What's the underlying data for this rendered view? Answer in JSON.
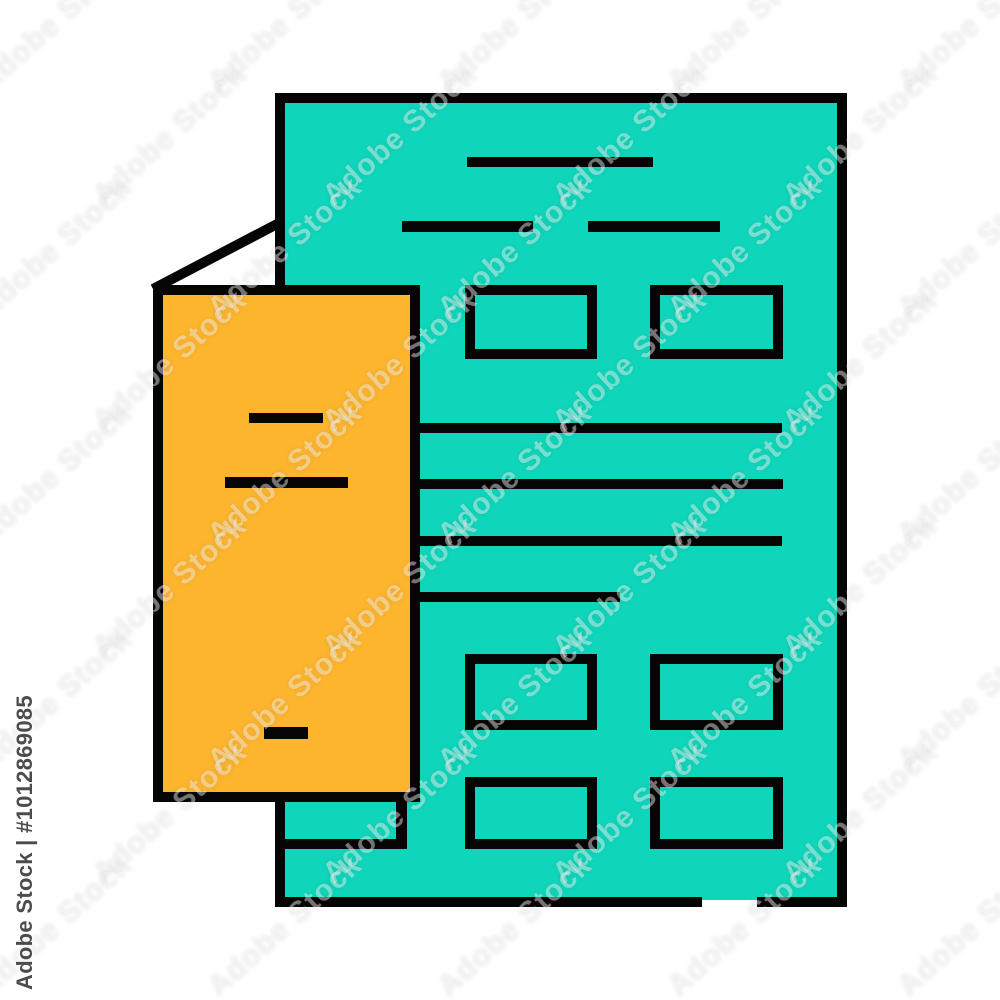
{
  "image": {
    "kind": "stock icon preview",
    "subject": "document page with bookmark card - flat color line icon (teal sheet with text lines and outlined field boxes, orange bookmark with folded corner)"
  },
  "colors": {
    "background": "#ffffff",
    "teal": "#0fd6bb",
    "orange": "#fdb52e",
    "outline": "#050505",
    "fold": "#ffffff",
    "id_text": "#4c4c4c"
  },
  "watermarks": {
    "id_text": "Adobe Stock | #1012869085",
    "tile_text": "Adobe Stock"
  }
}
